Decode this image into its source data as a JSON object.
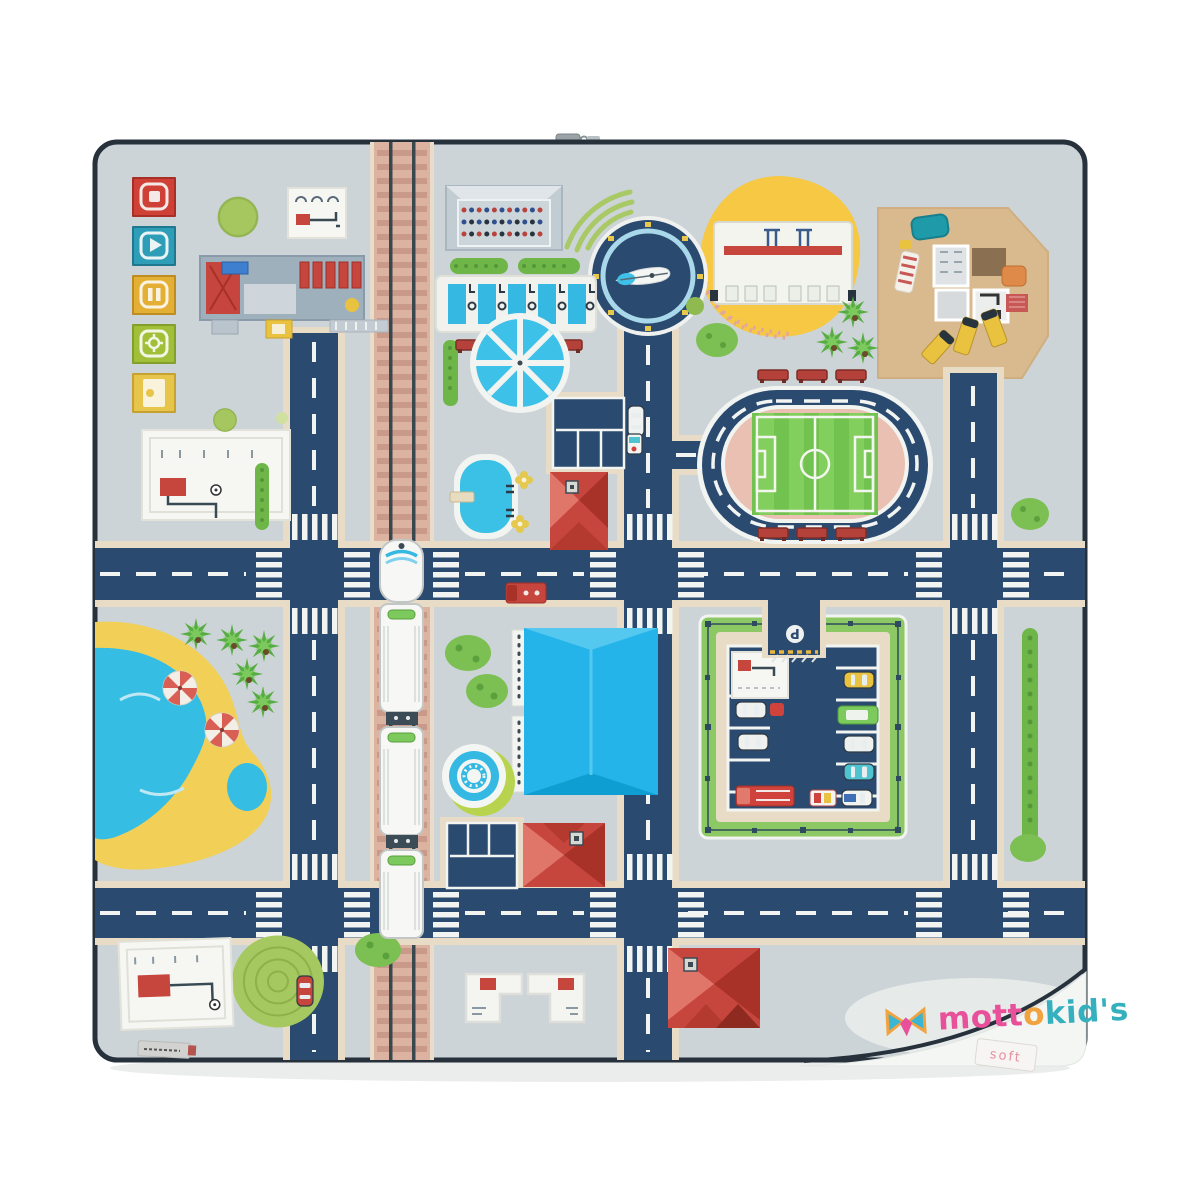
{
  "brand": {
    "name": "mottokids",
    "logo_segments": {
      "part1": "mott",
      "part2": "o",
      "part3": "kid's"
    }
  },
  "labels": {
    "soft_tag": "soft",
    "parking_sign": "P"
  },
  "palette": {
    "mat_base": "#ccd4d7",
    "road_navy": "#2b4a70",
    "road_shoulder": "#e8dcc6",
    "track_bed": "#dcb3a0",
    "marking_white": "#f4f6f4",
    "grass_green": "#8cc863",
    "bush_green": "#7cbf52",
    "water_blue": "#35bde4",
    "sand_yellow": "#f2cf56",
    "playground_yellow": "#f6c843",
    "house_tan": "#d9ba8e",
    "roof_red": "#c6453d",
    "mall_blue": "#24b4e9",
    "pitch_green": "#72c24f",
    "infield_pink": "#e9c0b2",
    "logo_pink": "#e8509a",
    "logo_orange": "#f0a33f",
    "logo_teal": "#35b0bf",
    "piping_navy": "#26313c"
  },
  "landmarks": [
    "media-icon-squares",
    "bus-depot",
    "railway",
    "passenger-train",
    "grandstand",
    "swimming-lanes",
    "water-wheel-fountain",
    "airplane-roundabout",
    "playground-circle",
    "furniture-house",
    "stadium",
    "lake-beach",
    "shopping-mall",
    "round-fountain",
    "parking-lot",
    "red-roof-houses",
    "blueprint-cards"
  ]
}
